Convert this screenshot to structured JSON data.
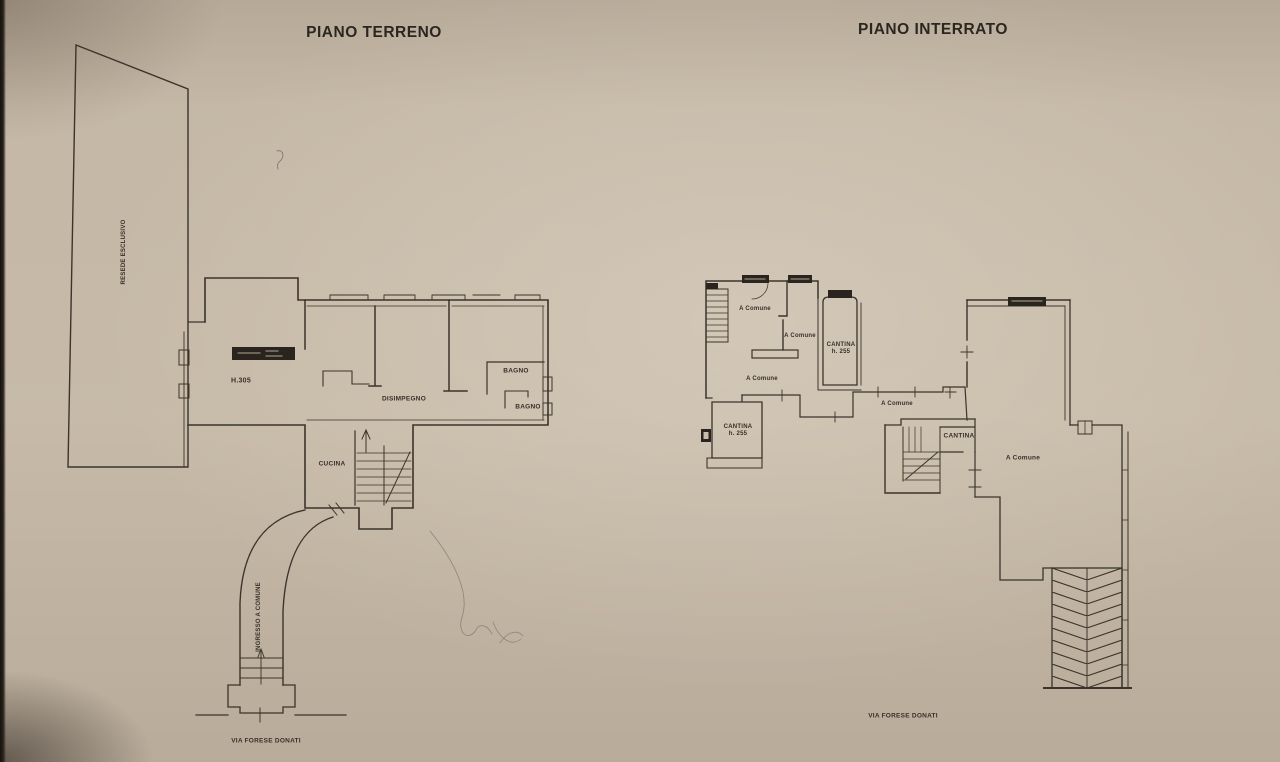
{
  "photo": {
    "paper_color": "#c9bcaa",
    "ink_color": "#3b342b",
    "window_fill_color": "#29241e"
  },
  "terreno": {
    "title": "PIANO TERRENO",
    "labels": {
      "resede": "RESEDE ESCLUSIVO",
      "h305": "H.305",
      "disimpegno": "DISIMPEGNO",
      "bagno_top": "BAGNO",
      "bagno_bottom": "BAGNO",
      "cucina": "CUCINA",
      "ingresso": "INGRESSO A COMUNE",
      "street": "VIA FORESE DONATI"
    }
  },
  "interrato": {
    "title": "PIANO INTERRATO",
    "labels": {
      "comune_top": "A Comune",
      "comune_mid": "A Comune",
      "comune_low": "A Comune",
      "comune_corridor": "A Comune",
      "comune_large": "A Comune",
      "cantina_right_name": "CANTINA",
      "cantina_right_height": "h. 255",
      "cantina_left_name": "CANTINA",
      "cantina_left_height": "h. 255",
      "cantina_mid": "CANTINA",
      "street": "VIA FORESE DONATI"
    }
  }
}
